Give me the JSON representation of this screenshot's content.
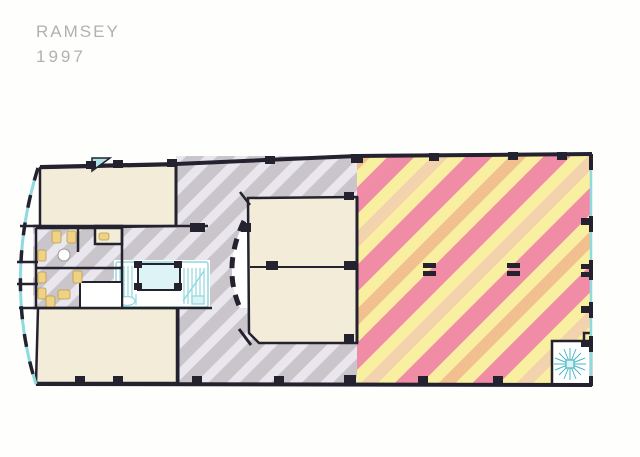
{
  "title_block": {
    "name": "RAMSEY",
    "year": "1997"
  },
  "palette": {
    "wall": "#23222e",
    "room_beige": "#f3ecd9",
    "gray_stripe_dark": "#c9c5cb",
    "gray_stripe_light": "#e9e7ed",
    "warm_pink": "#f08ca6",
    "warm_yellow": "#f8f0a0",
    "warm_peach": "#f2c08f",
    "warm_pale": "#f3d2ae",
    "cyan_line": "#8fd9df",
    "cyan_fill": "#ddf3f6",
    "fixture_yellow": "#f0d285",
    "paper_white": "#ffffff",
    "title_gray": "#b3b1ad"
  },
  "plan": {
    "zones": {
      "northwest_office": "beige room",
      "southwest_office": "beige room",
      "center_rooms": "two beige rooms with curved corridor wall",
      "gray_hatched_area": "diagonal gray hatch tenant area",
      "warm_hatched_area": "diagonal pink/yellow/peach hatch tenant area",
      "restrooms": "gray hatched with yellow fixtures",
      "core": "stair and elevator core (cyan)",
      "spiral_stair": "corner spiral stair (cyan)"
    }
  }
}
